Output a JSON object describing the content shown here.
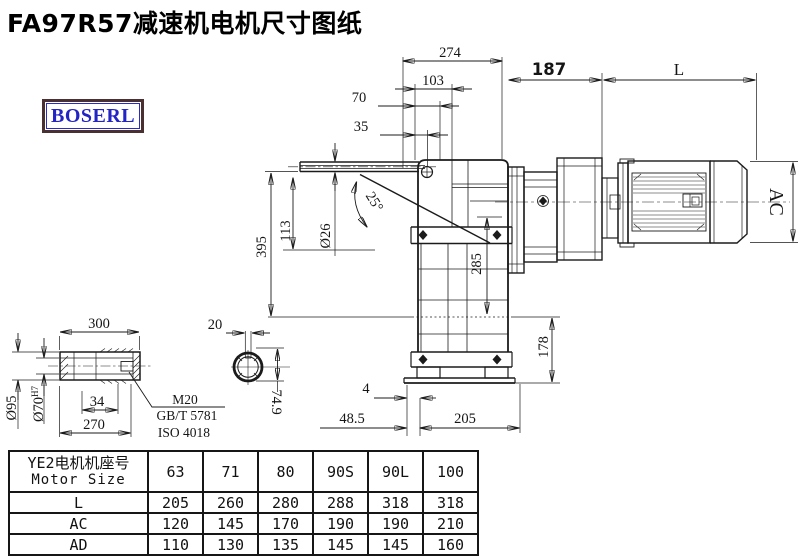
{
  "title": "FA97R57减速机电机尺寸图纸",
  "logo_text": "BOSERL",
  "colors": {
    "line": "#1b1b1b",
    "logo_text": "#2424c4",
    "logo_border": "#4a3030"
  },
  "drawing": {
    "top_dims": {
      "d274": "274",
      "d103": "103",
      "d70": "70",
      "d35": "35",
      "d187": "187",
      "dL": "L"
    },
    "left_dims": {
      "d395": "395",
      "d113": "113",
      "d26": "Ø26",
      "d25": "25°"
    },
    "right_dims": {
      "d285": "285",
      "d178": "178",
      "dAC": "AC"
    },
    "bottom_dims": {
      "d4": "4",
      "d48_5": "48.5",
      "d205": "205"
    },
    "shaft_detail": {
      "d300": "300",
      "d95": "Ø95",
      "d70b": "Ø70",
      "d70sup": "H7",
      "d34": "34",
      "d270": "270",
      "m20": "M20",
      "gbt": "GB/T 5781",
      "iso": "ISO 4018"
    },
    "section_detail": {
      "d20": "20",
      "d74_9": "74.9"
    }
  },
  "table": {
    "header_cn": "YE2电机机座号",
    "header_en": "Motor Size",
    "columns": [
      "63",
      "71",
      "80",
      "90S",
      "90L",
      "100"
    ],
    "rows": [
      {
        "label": "L",
        "values": [
          "205",
          "260",
          "280",
          "288",
          "318",
          "318"
        ]
      },
      {
        "label": "AC",
        "values": [
          "120",
          "145",
          "170",
          "190",
          "190",
          "210"
        ]
      },
      {
        "label": "AD",
        "values": [
          "110",
          "130",
          "135",
          "145",
          "145",
          "160"
        ]
      }
    ]
  }
}
